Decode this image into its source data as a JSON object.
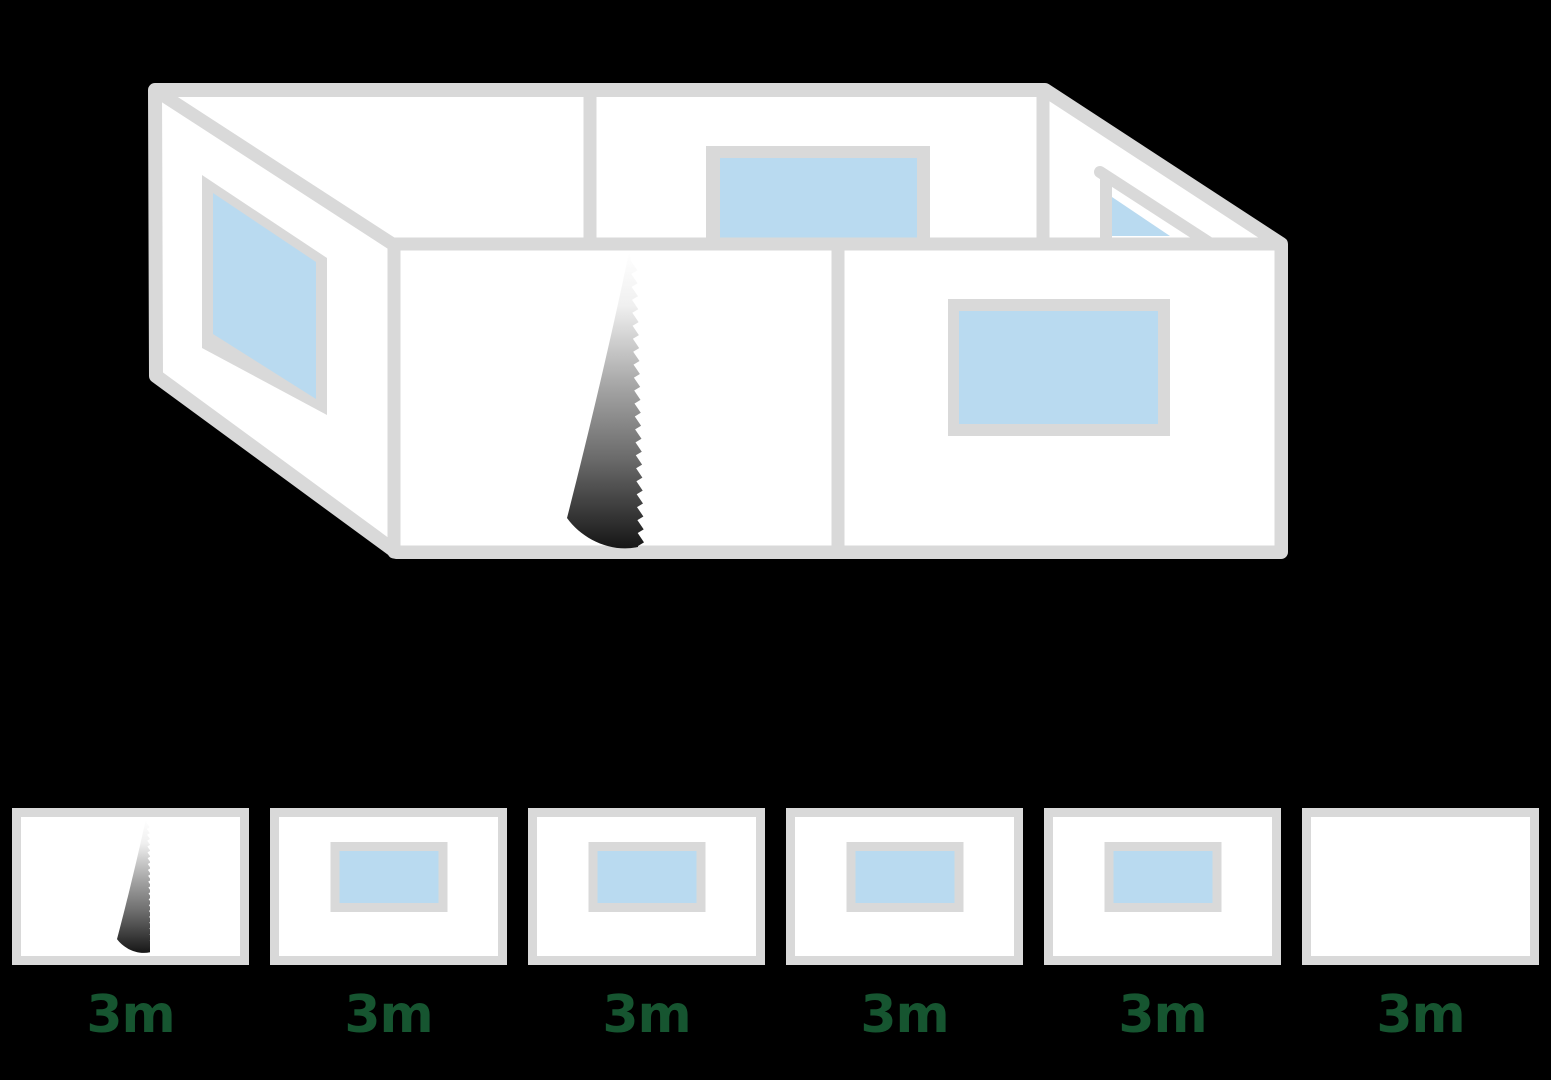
{
  "canvas": {
    "width": 1551,
    "height": 1080
  },
  "colors": {
    "background": "#000000",
    "wall_fill": "#ffffff",
    "frame_gray": "#d9d9d9",
    "glass_blue": "#b9daf0",
    "label_green": "#165530",
    "blade_dark": "#161616"
  },
  "diagram": {
    "name": "marquee-sidewall-isometric-layout",
    "walls": [
      {
        "id": "left-wall",
        "feature": "window"
      },
      {
        "id": "back-left-wall",
        "feature": "plain"
      },
      {
        "id": "back-center-wall",
        "feature": "window"
      },
      {
        "id": "right-wall",
        "feature": "window"
      },
      {
        "id": "front-left-wall",
        "feature": "zipper"
      },
      {
        "id": "front-right-wall",
        "feature": "window"
      }
    ]
  },
  "panels": [
    {
      "label": "3m",
      "type": "zipper"
    },
    {
      "label": "3m",
      "type": "window"
    },
    {
      "label": "3m",
      "type": "window"
    },
    {
      "label": "3m",
      "type": "window"
    },
    {
      "label": "3m",
      "type": "window"
    },
    {
      "label": "3m",
      "type": "plain"
    }
  ]
}
